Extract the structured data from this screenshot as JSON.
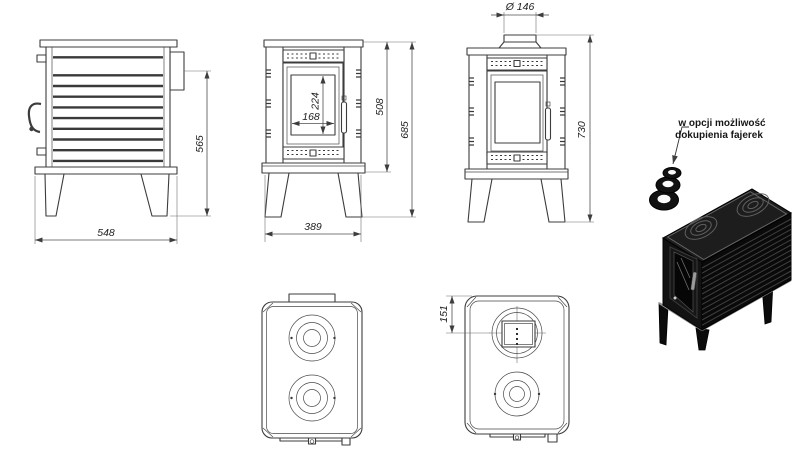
{
  "page": {
    "background": "#ffffff"
  },
  "drawing": {
    "line_color": "#3c3c3c",
    "dims": {
      "side_width": "548",
      "side_height": "565",
      "front_width": "389",
      "front_body_height": "508",
      "front_total_height": "685",
      "glass_height": "224",
      "glass_width": "168",
      "flue_diameter": "Ø 146",
      "chimney_total_height": "730",
      "flue_center_offset": "151"
    },
    "callout": {
      "line1": "w opcji możliwość",
      "line2": "dokupienia fajerek"
    },
    "colors": {
      "stove_black": "#111111",
      "dimension_gray": "#4f4f4f"
    }
  }
}
